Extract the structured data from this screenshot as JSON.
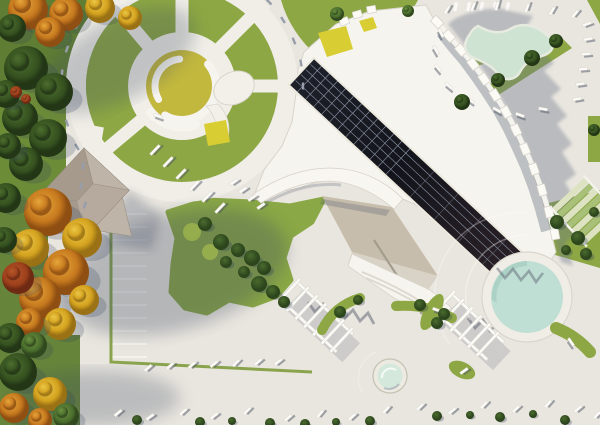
{
  "meta": {
    "title": "aerial-architectural-site-render",
    "description": "Top-down 3D architectural rendering: fan-shaped cultural building with dark rooftop solar strip, circular plaza, parking, pools, pergolas, lawns and autumn trees",
    "render_type": "3d-visualization",
    "visible_text": "none"
  },
  "colors": {
    "pavement": "#e9e6df",
    "walk": "#f0eee7",
    "roof_white": "#f6f4ee",
    "roof_edge": "#d8d4cb",
    "grass": "#8ca743",
    "grass_light": "#9cb251",
    "grass_dark": "#6e8d37",
    "lawn": "#8aa845",
    "bush": "#3c5a26",
    "center_yellow": "#c2b83e",
    "accent_yellow": "#d8cd33",
    "entrance_tan": "#c7bdac",
    "entrance_step": "#d9d3c7",
    "pond_mint": "#cfe3d3",
    "pond_edge": "#e7eadf",
    "pool_water": "#bfdfd4",
    "pool_rim": "#efede6",
    "terrace_green": "#a8c078",
    "terrace_pale": "#ddE3c2",
    "gable_a": "#b5aa9d",
    "gable_b": "#a59a8c",
    "gable_c": "#beb4a7",
    "solar_dark": "#191b24",
    "solar_brown": "#2b2127",
    "solar_line": "#9aa4b6",
    "shadow_blue": "#6d7689",
    "tick_dark": "#4e5665",
    "tick_white": "#fbfaf7",
    "bench_gray": "#979daa"
  },
  "scene": {
    "circle": {
      "cx": 182,
      "cy": 86,
      "radial_path_angles": [
        -130,
        -90,
        -45,
        0,
        140
      ],
      "wall_arcs": [
        {
          "r": 34,
          "a0": -40,
          "a1": 120,
          "w": 8
        },
        {
          "r": 27,
          "a0": 150,
          "a1": 265,
          "w": 7
        },
        {
          "r": 41,
          "a0": 70,
          "a1": 140,
          "w": 9
        }
      ],
      "benches": [
        {
          "x": 77,
          "y": 147,
          "a": 60
        },
        {
          "x": 67,
          "y": 123,
          "a": 72
        },
        {
          "x": 62,
          "y": 99,
          "a": 84
        },
        {
          "x": 62,
          "y": 73,
          "a": 96
        },
        {
          "x": 67,
          "y": 49,
          "a": 108
        },
        {
          "x": 77,
          "y": 26,
          "a": 120
        },
        {
          "x": 92,
          "y": 5,
          "a": 132
        },
        {
          "x": 269,
          "y": 2,
          "a": 46
        },
        {
          "x": 283,
          "y": 20,
          "a": 57
        },
        {
          "x": 294,
          "y": 41,
          "a": 68
        },
        {
          "x": 301,
          "y": 63,
          "a": 79
        },
        {
          "x": 303,
          "y": 86,
          "a": 90
        },
        {
          "x": 83,
          "y": 166,
          "a": 95
        },
        {
          "x": 81,
          "y": 186,
          "a": 100
        },
        {
          "x": 85,
          "y": 205,
          "a": 108
        }
      ]
    },
    "parking_left": {
      "x": 112,
      "len": 35,
      "y0": 214,
      "step": 13,
      "count": 12
    },
    "crosswalk": {
      "x0": 455,
      "y": 2,
      "step": 13,
      "count": 5,
      "w": 3.2,
      "h": 9
    },
    "building_blocks": [
      {
        "x": 437,
        "y": 22,
        "a": 46
      },
      {
        "x": 449,
        "y": 36,
        "a": 48
      },
      {
        "x": 461,
        "y": 50,
        "a": 50
      },
      {
        "x": 473,
        "y": 64,
        "a": 53
      },
      {
        "x": 484,
        "y": 79,
        "a": 56
      },
      {
        "x": 495,
        "y": 95,
        "a": 59
      },
      {
        "x": 506,
        "y": 112,
        "a": 62
      },
      {
        "x": 516,
        "y": 130,
        "a": 65
      },
      {
        "x": 525,
        "y": 149,
        "a": 68
      },
      {
        "x": 534,
        "y": 169,
        "a": 71
      },
      {
        "x": 542,
        "y": 190,
        "a": 74
      },
      {
        "x": 549,
        "y": 212,
        "a": 77
      },
      {
        "x": 555,
        "y": 234,
        "a": 80
      }
    ],
    "loungers": {
      "bottom": [
        {
          "x": 118,
          "y": 413,
          "a": -40
        },
        {
          "x": 150,
          "y": 417,
          "a": -35
        },
        {
          "x": 183,
          "y": 412,
          "a": -42
        },
        {
          "x": 214,
          "y": 416,
          "a": -38
        },
        {
          "x": 247,
          "y": 411,
          "a": -45
        },
        {
          "x": 288,
          "y": 418,
          "a": -40
        },
        {
          "x": 320,
          "y": 414,
          "a": -50
        },
        {
          "x": 352,
          "y": 417,
          "a": -42
        },
        {
          "x": 386,
          "y": 410,
          "a": -48
        },
        {
          "x": 420,
          "y": 407,
          "a": -44
        },
        {
          "x": 452,
          "y": 411,
          "a": -40
        },
        {
          "x": 484,
          "y": 405,
          "a": -46
        },
        {
          "x": 516,
          "y": 409,
          "a": -42
        },
        {
          "x": 548,
          "y": 404,
          "a": -48
        },
        {
          "x": 578,
          "y": 409,
          "a": -40
        },
        {
          "x": 597,
          "y": 415,
          "a": -45
        }
      ],
      "mid": [
        {
          "x": 148,
          "y": 368,
          "a": -40
        },
        {
          "x": 170,
          "y": 366,
          "a": -40
        },
        {
          "x": 192,
          "y": 365,
          "a": -42
        },
        {
          "x": 214,
          "y": 364,
          "a": -40
        },
        {
          "x": 236,
          "y": 363,
          "a": -44
        },
        {
          "x": 258,
          "y": 362,
          "a": -40
        },
        {
          "x": 278,
          "y": 362,
          "a": -38
        }
      ],
      "pond": [
        {
          "x": 447,
          "y": 10,
          "a": -60
        },
        {
          "x": 473,
          "y": 7,
          "a": -70
        },
        {
          "x": 497,
          "y": 6,
          "a": -75
        },
        {
          "x": 527,
          "y": 8,
          "a": -70
        },
        {
          "x": 552,
          "y": 11,
          "a": -60
        },
        {
          "x": 575,
          "y": 14,
          "a": -50
        },
        {
          "x": 587,
          "y": 24,
          "a": -20
        },
        {
          "x": 588,
          "y": 39,
          "a": -10
        },
        {
          "x": 586,
          "y": 54,
          "a": -5
        },
        {
          "x": 583,
          "y": 69,
          "a": -5
        },
        {
          "x": 580,
          "y": 84,
          "a": -8
        },
        {
          "x": 577,
          "y": 99,
          "a": -10
        },
        {
          "x": 497,
          "y": 110,
          "a": 30
        },
        {
          "x": 520,
          "y": 115,
          "a": 20
        },
        {
          "x": 543,
          "y": 109,
          "a": 10
        },
        {
          "x": 470,
          "y": 100,
          "a": 35
        },
        {
          "x": 449,
          "y": 86,
          "a": 40
        },
        {
          "x": 438,
          "y": 68,
          "a": 50
        },
        {
          "x": 436,
          "y": 50,
          "a": 60
        },
        {
          "x": 441,
          "y": 33,
          "a": 65
        }
      ],
      "drive": [
        {
          "x": 155,
          "y": 150,
          "a": -46
        },
        {
          "x": 168,
          "y": 162,
          "a": -46
        },
        {
          "x": 181,
          "y": 174,
          "a": -46
        },
        {
          "x": 194,
          "y": 186,
          "a": -46
        },
        {
          "x": 207,
          "y": 197,
          "a": -46
        },
        {
          "x": 220,
          "y": 208,
          "a": -46
        }
      ],
      "edge_steps": [
        {
          "x": 234,
          "y": 182,
          "a": -35
        },
        {
          "x": 243,
          "y": 190,
          "a": -35
        },
        {
          "x": 252,
          "y": 198,
          "a": -35
        },
        {
          "x": 261,
          "y": 206,
          "a": -35
        }
      ],
      "misc": [
        {
          "x": 571,
          "y": 342,
          "a": 55
        },
        {
          "x": 464,
          "y": 371,
          "a": -35
        },
        {
          "x": 437,
          "y": 310,
          "a": 20
        },
        {
          "x": 158,
          "y": 116,
          "a": 20
        }
      ]
    },
    "trees": [
      {
        "x": 28,
        "y": 10,
        "r": 20,
        "k": "o"
      },
      {
        "x": 66,
        "y": 14,
        "r": 17,
        "k": "o"
      },
      {
        "x": 100,
        "y": 8,
        "r": 15,
        "k": "y"
      },
      {
        "x": 130,
        "y": 18,
        "r": 12,
        "k": "y"
      },
      {
        "x": 50,
        "y": 32,
        "r": 15,
        "k": "o"
      },
      {
        "x": 12,
        "y": 28,
        "r": 14,
        "k": "d"
      },
      {
        "x": 26,
        "y": 68,
        "r": 22,
        "k": "d"
      },
      {
        "x": 54,
        "y": 92,
        "r": 19,
        "k": "d"
      },
      {
        "x": 20,
        "y": 118,
        "r": 18,
        "k": "d"
      },
      {
        "x": 48,
        "y": 138,
        "r": 19,
        "k": "d"
      },
      {
        "x": 26,
        "y": 164,
        "r": 17,
        "k": "d"
      },
      {
        "x": 6,
        "y": 94,
        "r": 14,
        "k": "d"
      },
      {
        "x": 8,
        "y": 146,
        "r": 13,
        "k": "d"
      },
      {
        "x": 16,
        "y": 92,
        "r": 6,
        "k": "r"
      },
      {
        "x": 26,
        "y": 99,
        "r": 5,
        "k": "r"
      },
      {
        "x": 48,
        "y": 212,
        "r": 24,
        "k": "o"
      },
      {
        "x": 82,
        "y": 238,
        "r": 20,
        "k": "y"
      },
      {
        "x": 30,
        "y": 248,
        "r": 19,
        "k": "y"
      },
      {
        "x": 66,
        "y": 272,
        "r": 23,
        "k": "o"
      },
      {
        "x": 40,
        "y": 298,
        "r": 21,
        "k": "o"
      },
      {
        "x": 84,
        "y": 300,
        "r": 15,
        "k": "y"
      },
      {
        "x": 18,
        "y": 278,
        "r": 16,
        "k": "r"
      },
      {
        "x": 60,
        "y": 324,
        "r": 16,
        "k": "y"
      },
      {
        "x": 30,
        "y": 322,
        "r": 14,
        "k": "o"
      },
      {
        "x": 6,
        "y": 198,
        "r": 15,
        "k": "d"
      },
      {
        "x": 4,
        "y": 240,
        "r": 13,
        "k": "d"
      },
      {
        "x": 10,
        "y": 338,
        "r": 15,
        "k": "d"
      },
      {
        "x": 34,
        "y": 345,
        "r": 13,
        "k": "g"
      },
      {
        "x": 18,
        "y": 372,
        "r": 19,
        "k": "d"
      },
      {
        "x": 50,
        "y": 394,
        "r": 17,
        "k": "y"
      },
      {
        "x": 14,
        "y": 408,
        "r": 15,
        "k": "o"
      },
      {
        "x": 66,
        "y": 416,
        "r": 13,
        "k": "g"
      },
      {
        "x": 40,
        "y": 420,
        "r": 12,
        "k": "o"
      },
      {
        "x": 337,
        "y": 14,
        "r": 7,
        "k": "g"
      },
      {
        "x": 408,
        "y": 11,
        "r": 6,
        "k": "g"
      },
      {
        "x": 462,
        "y": 102,
        "r": 8,
        "k": "d"
      },
      {
        "x": 498,
        "y": 80,
        "r": 7,
        "k": "d"
      },
      {
        "x": 532,
        "y": 58,
        "r": 8,
        "k": "d"
      },
      {
        "x": 556,
        "y": 41,
        "r": 7,
        "k": "d"
      },
      {
        "x": 594,
        "y": 130,
        "r": 6,
        "k": "d"
      }
    ],
    "bushes": [
      {
        "x": 205,
        "y": 224,
        "r": 7
      },
      {
        "x": 221,
        "y": 242,
        "r": 8
      },
      {
        "x": 238,
        "y": 250,
        "r": 7
      },
      {
        "x": 252,
        "y": 258,
        "r": 8
      },
      {
        "x": 264,
        "y": 268,
        "r": 7
      },
      {
        "x": 244,
        "y": 272,
        "r": 6
      },
      {
        "x": 259,
        "y": 284,
        "r": 8
      },
      {
        "x": 273,
        "y": 292,
        "r": 7
      },
      {
        "x": 284,
        "y": 302,
        "r": 6
      },
      {
        "x": 226,
        "y": 262,
        "r": 6
      },
      {
        "x": 557,
        "y": 222,
        "r": 7
      },
      {
        "x": 578,
        "y": 238,
        "r": 7
      },
      {
        "x": 586,
        "y": 254,
        "r": 6
      },
      {
        "x": 566,
        "y": 250,
        "r": 5
      },
      {
        "x": 594,
        "y": 212,
        "r": 5
      },
      {
        "x": 340,
        "y": 312,
        "r": 6
      },
      {
        "x": 358,
        "y": 300,
        "r": 5
      },
      {
        "x": 420,
        "y": 305,
        "r": 6
      },
      {
        "x": 444,
        "y": 314,
        "r": 6
      },
      {
        "x": 437,
        "y": 323,
        "r": 6
      },
      {
        "x": 137,
        "y": 420,
        "r": 5
      },
      {
        "x": 200,
        "y": 422,
        "r": 5
      },
      {
        "x": 232,
        "y": 421,
        "r": 4
      },
      {
        "x": 270,
        "y": 423,
        "r": 5
      },
      {
        "x": 305,
        "y": 424,
        "r": 5
      },
      {
        "x": 336,
        "y": 422,
        "r": 4
      },
      {
        "x": 370,
        "y": 421,
        "r": 5
      },
      {
        "x": 437,
        "y": 416,
        "r": 5
      },
      {
        "x": 470,
        "y": 415,
        "r": 4
      },
      {
        "x": 500,
        "y": 417,
        "r": 5
      },
      {
        "x": 533,
        "y": 414,
        "r": 4
      },
      {
        "x": 565,
        "y": 420,
        "r": 5
      }
    ],
    "lawn_mounds": [
      {
        "x": 192,
        "y": 232,
        "r": 9
      },
      {
        "x": 210,
        "y": 252,
        "r": 8
      }
    ]
  }
}
